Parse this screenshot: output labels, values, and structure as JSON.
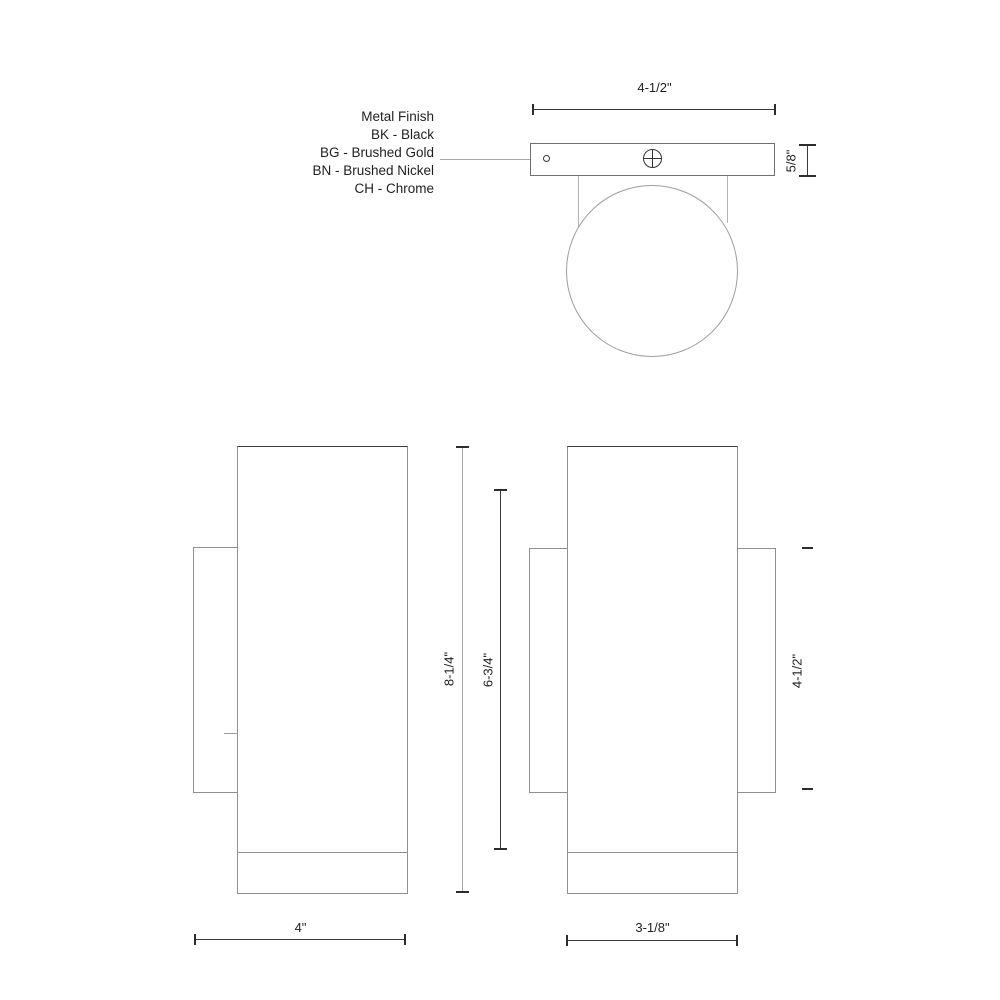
{
  "legend": {
    "title": "Metal Finish",
    "options": [
      "BK - Black",
      "BG - Brushed Gold",
      "BN - Brushed Nickel",
      "CH - Chrome"
    ]
  },
  "dimensions": {
    "top_width": "4-1/2\"",
    "plate_thickness": "5/8\"",
    "overall_height": "8-1/4\"",
    "body_height": "6-3/4\"",
    "side_depth": "4\"",
    "backplate_height": "4-1/2\"",
    "front_width": "3-1/8\""
  },
  "colors": {
    "background": "#ffffff",
    "object_line": "#8f8f8f",
    "dimension_line": "#2d2d2d",
    "text": "#1f1f1f"
  }
}
